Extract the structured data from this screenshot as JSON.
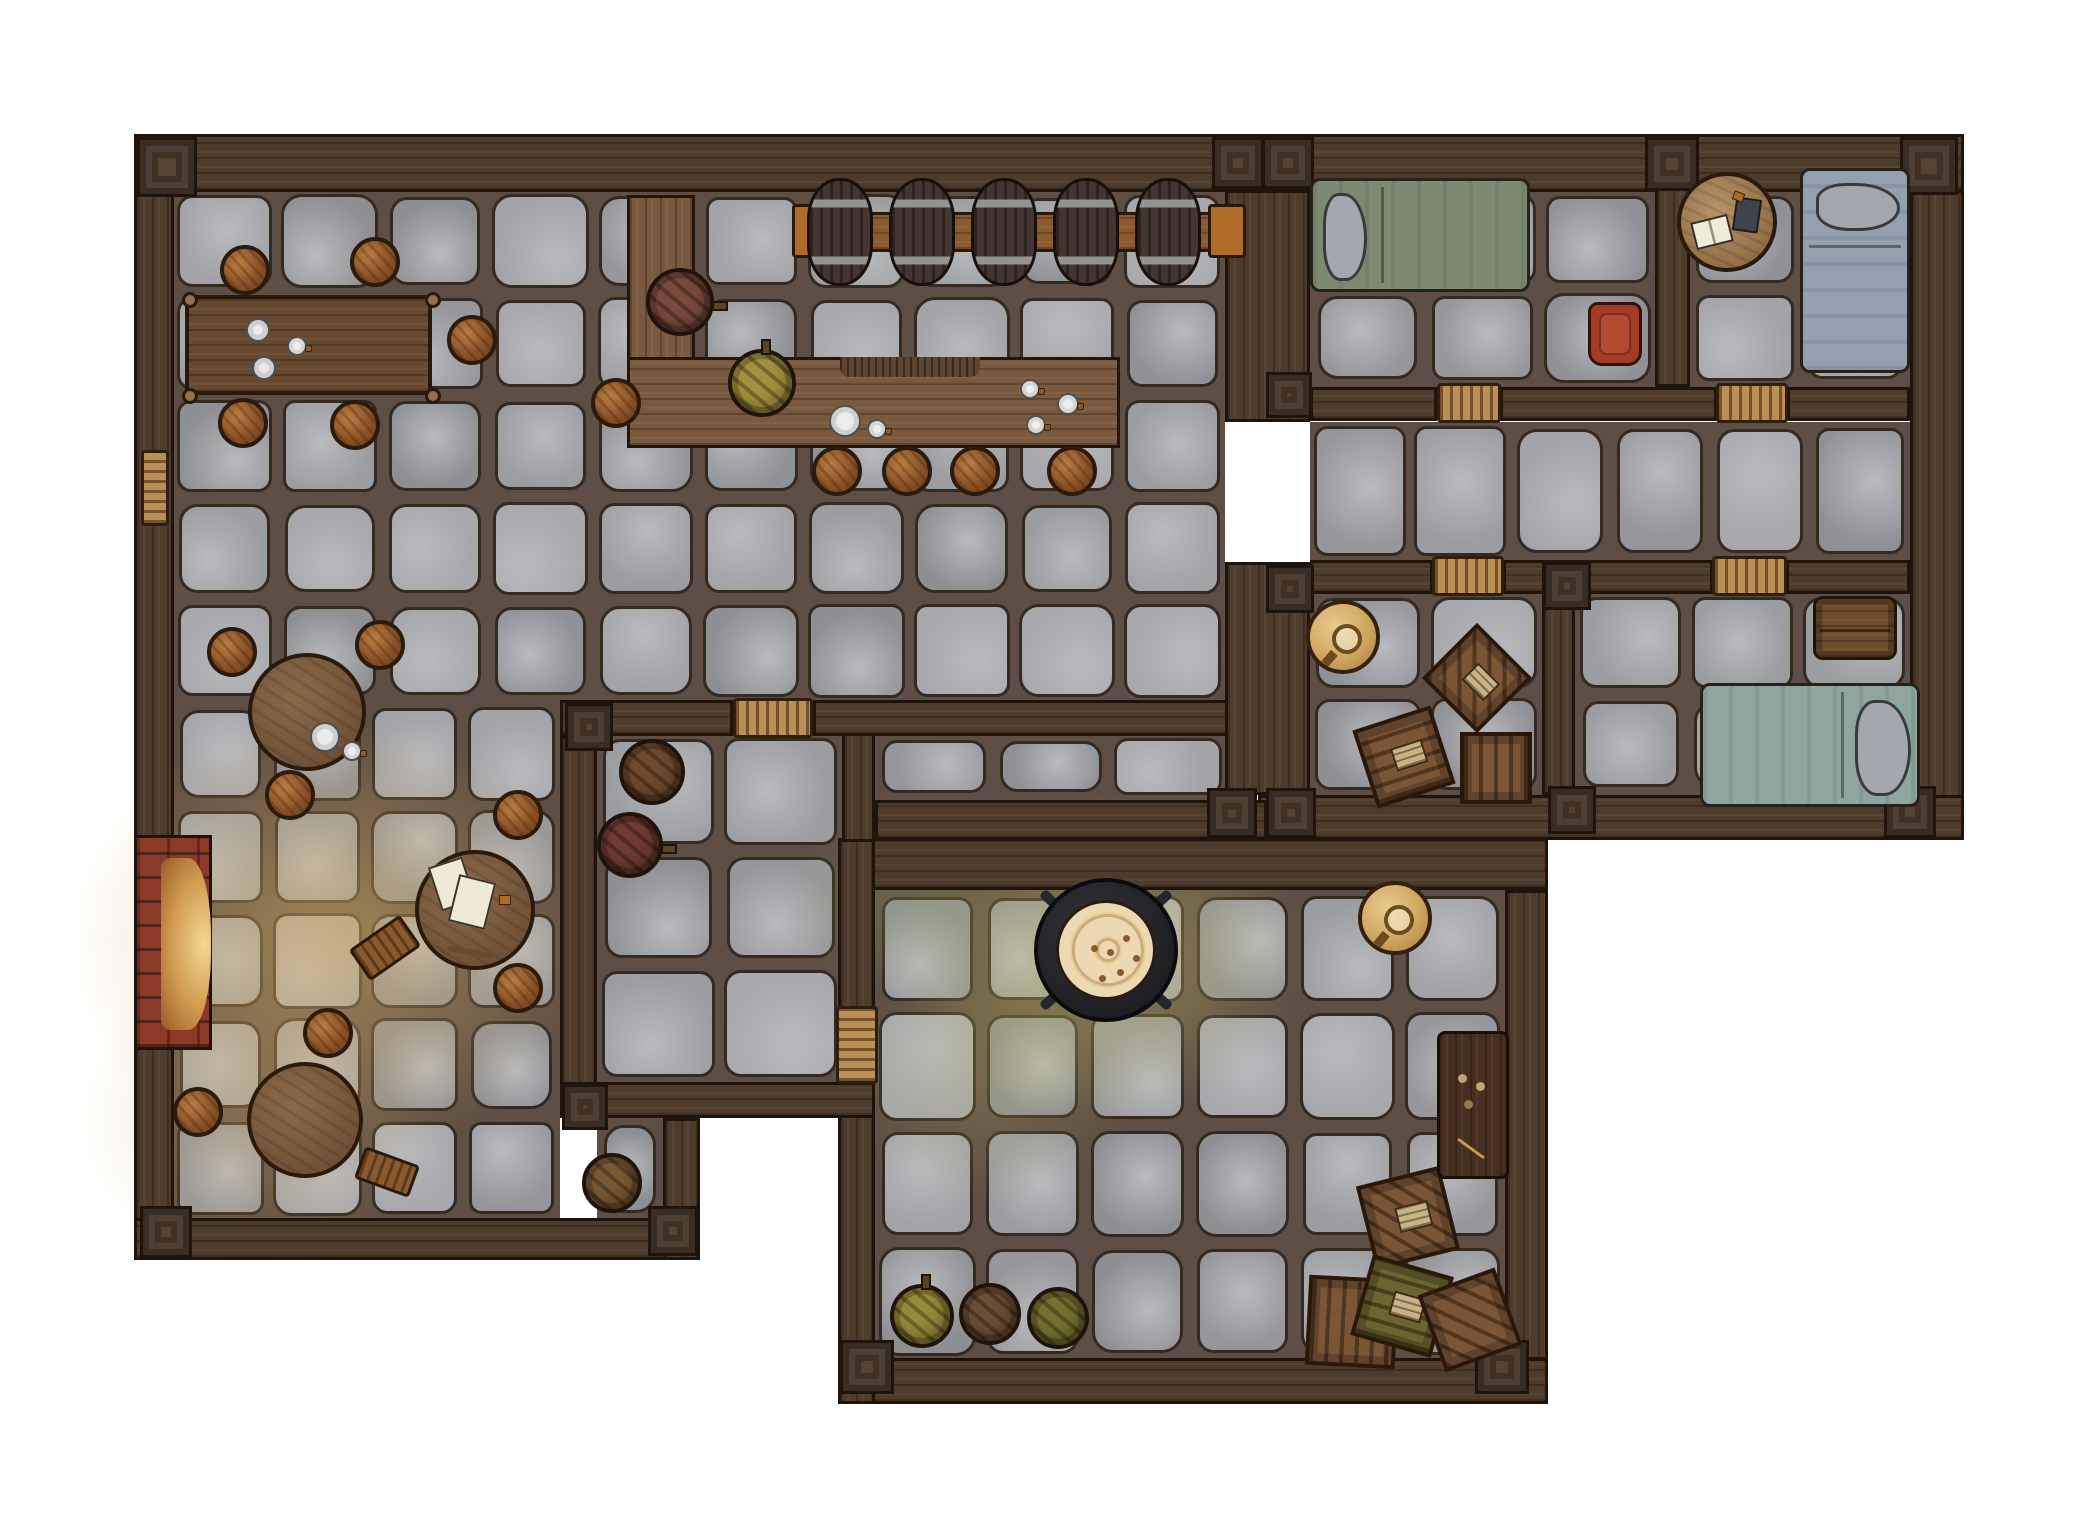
{
  "scene": {
    "width": 2100,
    "height": 1540,
    "background": "#ffffff",
    "label": "top-down tavern inn battle map with stone floors and wooden walls"
  },
  "palette": {
    "grout": "#5d4f45",
    "stoneLine": "#352a21",
    "stoneLight": "#b9babe",
    "stones": [
      "#a3a3a7",
      "#97979b",
      "#8e8f93",
      "#9c9da1",
      "#a8a8ac",
      "#909196"
    ],
    "wall": "#4d3b2b",
    "wallLine": "#1f140b",
    "post": "#564230",
    "door": "#bb9057",
    "counter": "#7a5a3e",
    "counterLine": "#241508",
    "brick": "#8a3a26",
    "glowWarm": "rgba(216,178,100,0.55)",
    "glowGreen": "rgba(196,188,98,0.50)"
  },
  "floors": [
    {
      "name": "tavern-hall",
      "x": 172,
      "y": 190,
      "w": 1053,
      "h": 512
    },
    {
      "name": "tavern-lower",
      "x": 172,
      "y": 702,
      "w": 388,
      "h": 518
    },
    {
      "name": "cellar-nook",
      "x": 597,
      "y": 1118,
      "w": 66,
      "h": 102
    },
    {
      "name": "keg-room",
      "x": 597,
      "y": 733,
      "w": 245,
      "h": 349
    },
    {
      "name": "corridor",
      "x": 875,
      "y": 733,
      "w": 352,
      "h": 67
    },
    {
      "name": "bedroom-1",
      "x": 1310,
      "y": 190,
      "w": 345,
      "h": 197
    },
    {
      "name": "bedroom-2",
      "x": 1690,
      "y": 190,
      "w": 220,
      "h": 197
    },
    {
      "name": "upper-hallway",
      "x": 1310,
      "y": 422,
      "w": 600,
      "h": 138
    },
    {
      "name": "storeroom",
      "x": 1310,
      "y": 592,
      "w": 232,
      "h": 203
    },
    {
      "name": "bedroom-3",
      "x": 1575,
      "y": 592,
      "w": 335,
      "h": 203
    },
    {
      "name": "kitchen",
      "x": 875,
      "y": 890,
      "w": 630,
      "h": 470
    }
  ],
  "glows": [
    {
      "cx": 330,
      "cy": 940,
      "rx": 280,
      "ry": 230,
      "color": "rgba(216,178,100,0.55)"
    },
    {
      "cx": 250,
      "cy": 1120,
      "rx": 190,
      "ry": 160,
      "color": "rgba(205,170,100,0.30)"
    },
    {
      "cx": 1100,
      "cy": 955,
      "rx": 215,
      "ry": 170,
      "color": "rgba(196,188,98,0.50)"
    },
    {
      "cx": 990,
      "cy": 1080,
      "rx": 150,
      "ry": 130,
      "color": "rgba(180,180,95,0.25)"
    },
    {
      "cx": 900,
      "cy": 905,
      "rx": 120,
      "ry": 95,
      "color": "rgba(150,170,90,0.25)"
    }
  ],
  "walls": [
    {
      "x": 134,
      "y": 134,
      "w": 1830,
      "h": 58,
      "dir": "h"
    },
    {
      "x": 134,
      "y": 190,
      "w": 40,
      "h": 1070,
      "dir": "v"
    },
    {
      "x": 1910,
      "y": 190,
      "w": 54,
      "h": 650,
      "dir": "v"
    },
    {
      "x": 134,
      "y": 1218,
      "w": 566,
      "h": 42,
      "dir": "h"
    },
    {
      "x": 1258,
      "y": 795,
      "w": 706,
      "h": 45,
      "dir": "h"
    },
    {
      "x": 838,
      "y": 838,
      "w": 710,
      "h": 52,
      "dir": "h"
    },
    {
      "x": 875,
      "y": 800,
      "w": 392,
      "h": 40,
      "dir": "h"
    },
    {
      "x": 1505,
      "y": 890,
      "w": 43,
      "h": 470,
      "dir": "v"
    },
    {
      "x": 838,
      "y": 1358,
      "w": 710,
      "h": 46,
      "dir": "h"
    },
    {
      "x": 838,
      "y": 838,
      "w": 37,
      "h": 176,
      "dir": "v"
    },
    {
      "x": 838,
      "y": 1084,
      "w": 37,
      "h": 320,
      "dir": "v"
    },
    {
      "x": 842,
      "y": 700,
      "w": 33,
      "h": 142,
      "dir": "v"
    },
    {
      "x": 560,
      "y": 700,
      "w": 173,
      "h": 36,
      "dir": "h"
    },
    {
      "x": 813,
      "y": 700,
      "w": 449,
      "h": 36,
      "dir": "h"
    },
    {
      "x": 560,
      "y": 736,
      "w": 37,
      "h": 382,
      "dir": "v"
    },
    {
      "x": 560,
      "y": 1082,
      "w": 315,
      "h": 36,
      "dir": "h"
    },
    {
      "x": 663,
      "y": 1118,
      "w": 37,
      "h": 142,
      "dir": "v"
    },
    {
      "x": 1225,
      "y": 190,
      "w": 85,
      "h": 232,
      "dir": "v"
    },
    {
      "x": 1225,
      "y": 562,
      "w": 85,
      "h": 233,
      "dir": "v"
    },
    {
      "x": 1310,
      "y": 387,
      "w": 127,
      "h": 34,
      "dir": "h"
    },
    {
      "x": 1500,
      "y": 387,
      "w": 217,
      "h": 34,
      "dir": "h"
    },
    {
      "x": 1787,
      "y": 387,
      "w": 123,
      "h": 34,
      "dir": "h"
    },
    {
      "x": 1655,
      "y": 134,
      "w": 35,
      "h": 253,
      "dir": "v"
    },
    {
      "x": 1310,
      "y": 560,
      "w": 123,
      "h": 34,
      "dir": "h"
    },
    {
      "x": 1503,
      "y": 560,
      "w": 210,
      "h": 34,
      "dir": "h"
    },
    {
      "x": 1786,
      "y": 560,
      "w": 124,
      "h": 34,
      "dir": "h"
    },
    {
      "x": 1542,
      "y": 562,
      "w": 33,
      "h": 233,
      "dir": "v"
    }
  ],
  "posts": [
    {
      "x": 137,
      "y": 137,
      "s": 60
    },
    {
      "x": 1212,
      "y": 137,
      "s": 52
    },
    {
      "x": 1262,
      "y": 137,
      "s": 52
    },
    {
      "x": 1645,
      "y": 137,
      "s": 54
    },
    {
      "x": 1900,
      "y": 137,
      "s": 58
    },
    {
      "x": 565,
      "y": 703,
      "s": 48
    },
    {
      "x": 1207,
      "y": 788,
      "s": 50
    },
    {
      "x": 1266,
      "y": 788,
      "s": 50
    },
    {
      "x": 1266,
      "y": 372,
      "s": 46
    },
    {
      "x": 1266,
      "y": 565,
      "s": 48
    },
    {
      "x": 1543,
      "y": 562,
      "s": 48
    },
    {
      "x": 1548,
      "y": 786,
      "s": 48
    },
    {
      "x": 1884,
      "y": 786,
      "s": 52
    },
    {
      "x": 140,
      "y": 1206,
      "s": 52
    },
    {
      "x": 648,
      "y": 1206,
      "s": 50
    },
    {
      "x": 562,
      "y": 1084,
      "s": 46
    },
    {
      "x": 840,
      "y": 1340,
      "s": 54
    },
    {
      "x": 1475,
      "y": 1340,
      "s": 54
    }
  ],
  "doors": [
    {
      "x": 733,
      "y": 698,
      "w": 80,
      "h": 40,
      "dir": "h",
      "kind": "door-icon"
    },
    {
      "x": 836,
      "y": 1006,
      "w": 42,
      "h": 78,
      "dir": "v",
      "kind": "door-icon"
    },
    {
      "x": 1437,
      "y": 383,
      "w": 64,
      "h": 40,
      "dir": "h",
      "kind": "door-icon"
    },
    {
      "x": 1716,
      "y": 383,
      "w": 72,
      "h": 40,
      "dir": "h",
      "kind": "door-icon"
    },
    {
      "x": 1432,
      "y": 556,
      "w": 72,
      "h": 40,
      "dir": "h",
      "kind": "door-icon"
    },
    {
      "x": 1712,
      "y": 556,
      "w": 75,
      "h": 40,
      "dir": "h",
      "kind": "door-icon"
    },
    {
      "x": 141,
      "y": 450,
      "w": 28,
      "h": 76,
      "dir": "v",
      "kind": "wall-bench"
    }
  ],
  "fireplace": {
    "x": 134,
    "y": 835,
    "w": 78,
    "h": 215
  },
  "furniture": [
    {
      "type": "counter",
      "x": 627,
      "y": 195,
      "w": 68,
      "h": 252,
      "dir": "v"
    },
    {
      "type": "counter",
      "x": 627,
      "y": 357,
      "w": 493,
      "h": 91,
      "dir": "h"
    },
    {
      "type": "hatch",
      "x": 840,
      "y": 357,
      "w": 140,
      "h": 20
    },
    {
      "type": "beam",
      "x": 798,
      "y": 212,
      "w": 440,
      "h": 40
    },
    {
      "type": "bracket",
      "x": 792,
      "y": 204,
      "w": 36,
      "h": 54
    },
    {
      "type": "bracket",
      "x": 1208,
      "y": 204,
      "w": 38,
      "h": 54
    },
    {
      "type": "barrel-side",
      "cx": 840,
      "cy": 232
    },
    {
      "type": "barrel-side",
      "cx": 922,
      "cy": 232
    },
    {
      "type": "barrel-side",
      "cx": 1004,
      "cy": 232
    },
    {
      "type": "barrel-side",
      "cx": 1086,
      "cy": 232
    },
    {
      "type": "barrel-side",
      "cx": 1168,
      "cy": 232
    },
    {
      "type": "dining-table",
      "x": 185,
      "y": 295,
      "w": 247,
      "h": 100
    },
    {
      "type": "round-table",
      "cx": 307,
      "cy": 712,
      "d": 118
    },
    {
      "type": "round-table",
      "cx": 475,
      "cy": 910,
      "d": 120
    },
    {
      "type": "round-table",
      "cx": 305,
      "cy": 1120,
      "d": 116
    },
    {
      "type": "stool",
      "cx": 245,
      "cy": 270
    },
    {
      "type": "stool",
      "cx": 375,
      "cy": 262
    },
    {
      "type": "stool",
      "cx": 472,
      "cy": 340
    },
    {
      "type": "stool",
      "cx": 243,
      "cy": 423
    },
    {
      "type": "stool",
      "cx": 355,
      "cy": 425
    },
    {
      "type": "stool",
      "cx": 616,
      "cy": 403
    },
    {
      "type": "stool",
      "cx": 232,
      "cy": 652
    },
    {
      "type": "stool",
      "cx": 380,
      "cy": 645
    },
    {
      "type": "stool",
      "cx": 290,
      "cy": 795
    },
    {
      "type": "stool",
      "cx": 518,
      "cy": 815
    },
    {
      "type": "stool",
      "cx": 518,
      "cy": 988
    },
    {
      "type": "stool",
      "cx": 328,
      "cy": 1033
    },
    {
      "type": "stool",
      "cx": 198,
      "cy": 1112
    },
    {
      "type": "stool",
      "cx": 837,
      "cy": 471
    },
    {
      "type": "stool",
      "cx": 907,
      "cy": 471
    },
    {
      "type": "stool",
      "cx": 975,
      "cy": 471
    },
    {
      "type": "stool",
      "cx": 1072,
      "cy": 471
    },
    {
      "type": "barrel-top",
      "cx": 680,
      "cy": 302,
      "d": 68,
      "color": "#7a4a3c",
      "spigot": "right"
    },
    {
      "type": "barrel-top",
      "cx": 762,
      "cy": 383,
      "d": 68,
      "color": "#a0923e",
      "spigot": "up"
    },
    {
      "type": "barrel-top",
      "cx": 652,
      "cy": 772,
      "d": 66,
      "color": "#6f4a2c"
    },
    {
      "type": "barrel-top",
      "cx": 630,
      "cy": 845,
      "d": 66,
      "color": "#6f3b33",
      "spigot": "right"
    },
    {
      "type": "barrel-top",
      "cx": 612,
      "cy": 1183,
      "d": 60,
      "color": "#7a5a33"
    },
    {
      "type": "barrel-top",
      "cx": 922,
      "cy": 1316,
      "d": 64,
      "color": "#958a39",
      "spigot": "up"
    },
    {
      "type": "barrel-top",
      "cx": 990,
      "cy": 1314,
      "d": 62,
      "color": "#6b4f35"
    },
    {
      "type": "barrel-top",
      "cx": 1058,
      "cy": 1318,
      "d": 62,
      "color": "#76702f"
    },
    {
      "type": "bench",
      "cx": 385,
      "cy": 948,
      "w": 62,
      "h": 38,
      "rot": -35
    },
    {
      "type": "bench",
      "cx": 387,
      "cy": 1172,
      "w": 58,
      "h": 34,
      "rot": 20
    },
    {
      "type": "bed",
      "x": 1310,
      "y": 178,
      "w": 220,
      "h": 114,
      "color": "#7c8a72",
      "pillow": {
        "x": 10,
        "y": 12,
        "w": 44,
        "h": 88
      },
      "fold": "v"
    },
    {
      "type": "bed",
      "x": 1800,
      "y": 168,
      "w": 110,
      "h": 205,
      "color": "#93a0ae",
      "pillow": {
        "x": 13,
        "y": 12,
        "w": 84,
        "h": 48
      },
      "fold": "h"
    },
    {
      "type": "bed",
      "x": 1700,
      "y": 683,
      "w": 220,
      "h": 124,
      "color": "#8fa6a0",
      "pillow": {
        "x": 152,
        "y": 14,
        "w": 56,
        "h": 96
      },
      "fold": "v2"
    },
    {
      "type": "armchair",
      "x": 1588,
      "y": 302,
      "w": 54,
      "h": 64
    },
    {
      "type": "round-desk",
      "cx": 1727,
      "cy": 222,
      "d": 100
    },
    {
      "type": "chest",
      "x": 1813,
      "y": 596,
      "w": 84,
      "h": 64
    },
    {
      "type": "crate",
      "cx": 1477,
      "cy": 678,
      "s": 78,
      "rot": 45,
      "style": "diag",
      "label": true
    },
    {
      "type": "crate",
      "cx": 1404,
      "cy": 757,
      "s": 82,
      "rot": -18,
      "style": "planks-h",
      "label": true
    },
    {
      "type": "crate",
      "cx": 1496,
      "cy": 768,
      "s": 72,
      "rot": 0,
      "style": "planks-v",
      "label": false
    },
    {
      "type": "crate",
      "cx": 1408,
      "cy": 1218,
      "s": 86,
      "rot": -14,
      "style": "diag",
      "label": true
    },
    {
      "type": "crate",
      "cx": 1352,
      "cy": 1322,
      "s": 90,
      "rot": 3,
      "style": "planks-v",
      "label": false
    },
    {
      "type": "crate",
      "cx": 1402,
      "cy": 1306,
      "s": 84,
      "rot": 16,
      "style": "planks-h",
      "label": true,
      "olive": true
    },
    {
      "type": "crate",
      "cx": 1470,
      "cy": 1320,
      "s": 82,
      "rot": -20,
      "style": "diag",
      "label": false
    },
    {
      "type": "gold-table",
      "cx": 1343,
      "cy": 637,
      "d": 74
    },
    {
      "type": "gold-table",
      "cx": 1395,
      "cy": 918,
      "d": 74
    },
    {
      "type": "cauldron",
      "cx": 1106,
      "cy": 950
    },
    {
      "type": "writing-desk",
      "x": 1437,
      "y": 1031,
      "w": 72,
      "h": 148
    }
  ],
  "deco": [
    {
      "t": "plate",
      "cx": 258,
      "cy": 330,
      "d": 24
    },
    {
      "t": "plate",
      "cx": 264,
      "cy": 368,
      "d": 24
    },
    {
      "t": "mug",
      "cx": 297,
      "cy": 346,
      "d": 20
    },
    {
      "t": "plate",
      "cx": 325,
      "cy": 737,
      "d": 30
    },
    {
      "t": "mug",
      "cx": 352,
      "cy": 751,
      "d": 20
    },
    {
      "t": "plate",
      "cx": 845,
      "cy": 421,
      "d": 32
    },
    {
      "t": "mug",
      "cx": 877,
      "cy": 429,
      "d": 20
    },
    {
      "t": "mug",
      "cx": 1030,
      "cy": 389,
      "d": 20
    },
    {
      "t": "mug",
      "cx": 1068,
      "cy": 404,
      "d": 22
    },
    {
      "t": "mug",
      "cx": 1036,
      "cy": 425,
      "d": 20
    },
    {
      "t": "paper",
      "cx": 452,
      "cy": 884,
      "w": 36,
      "h": 46,
      "rot": -18
    },
    {
      "t": "paper",
      "cx": 472,
      "cy": 902,
      "w": 38,
      "h": 48,
      "rot": 14
    },
    {
      "t": "stick",
      "cx": 470,
      "cy": 952,
      "w": 46,
      "h": 6,
      "rot": 10
    },
    {
      "t": "chip",
      "cx": 505,
      "cy": 900,
      "w": 12,
      "h": 10,
      "rot": 0
    },
    {
      "t": "book-open",
      "cx": 1712,
      "cy": 232,
      "w": 38,
      "h": 28,
      "rot": -14
    },
    {
      "t": "book-dark",
      "cx": 1747,
      "cy": 215,
      "w": 26,
      "h": 34,
      "rot": 8
    },
    {
      "t": "chip",
      "cx": 1738,
      "cy": 196,
      "w": 11,
      "h": 9,
      "rot": 20
    }
  ]
}
